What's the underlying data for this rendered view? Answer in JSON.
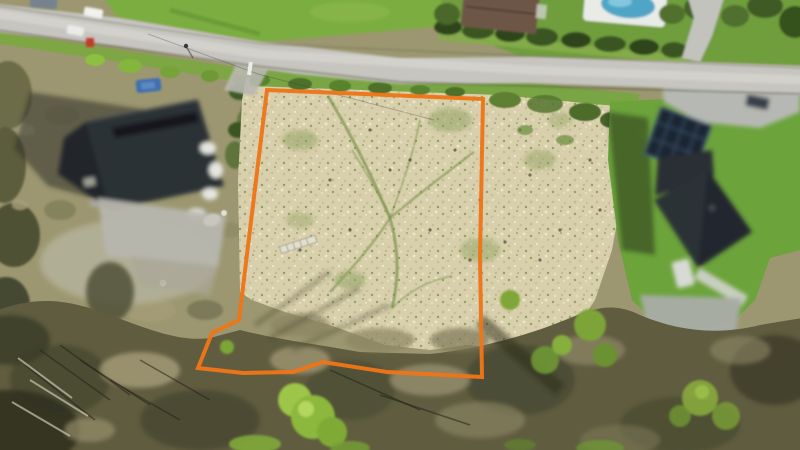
{
  "meta": {
    "type": "aerial-drone-photo",
    "width": 800,
    "height": 450
  },
  "scene": {
    "subject": "Vacant building plot outlined in orange, bordered by a rural road at the top, a dark-roofed house on the left and a solar-panelled house on the right, with woodland along the bottom",
    "annotation": {
      "parcel_outline_color": "#EE7518",
      "parcel_outline_stroke_width": 4,
      "parcel_outline_points": "267,90 483,99 480,257 482,377 387,372 323,362 293,372 243,373 198,368 212,333 239,320"
    },
    "objects": [
      "rural-road",
      "pedestrian-on-road",
      "white-car-1",
      "white-car-2",
      "blue-gray-car",
      "red-object",
      "left-house-dark-roof",
      "left-driveway",
      "blue-car-parked",
      "brown-roof-house",
      "swimming-pool",
      "hedge-row",
      "right-house-solar-roof",
      "solar-panels",
      "right-driveway",
      "white-trailer",
      "garden-walkway",
      "parcel-field",
      "ladder-in-field",
      "woodland-strip",
      "bright-green-trees"
    ],
    "palette": {
      "road": "#C6C5C0",
      "grass_bright": "#7CAD41",
      "field_beige": "#D8CFAC",
      "lawn_green": "#6CA33B",
      "woodland_dark": "#605C3F",
      "roof_dark": "#2C3036",
      "pool_blue": "#4FA5C6",
      "car_blue": "#3F6FB0",
      "outline_orange": "#EE7518"
    }
  }
}
